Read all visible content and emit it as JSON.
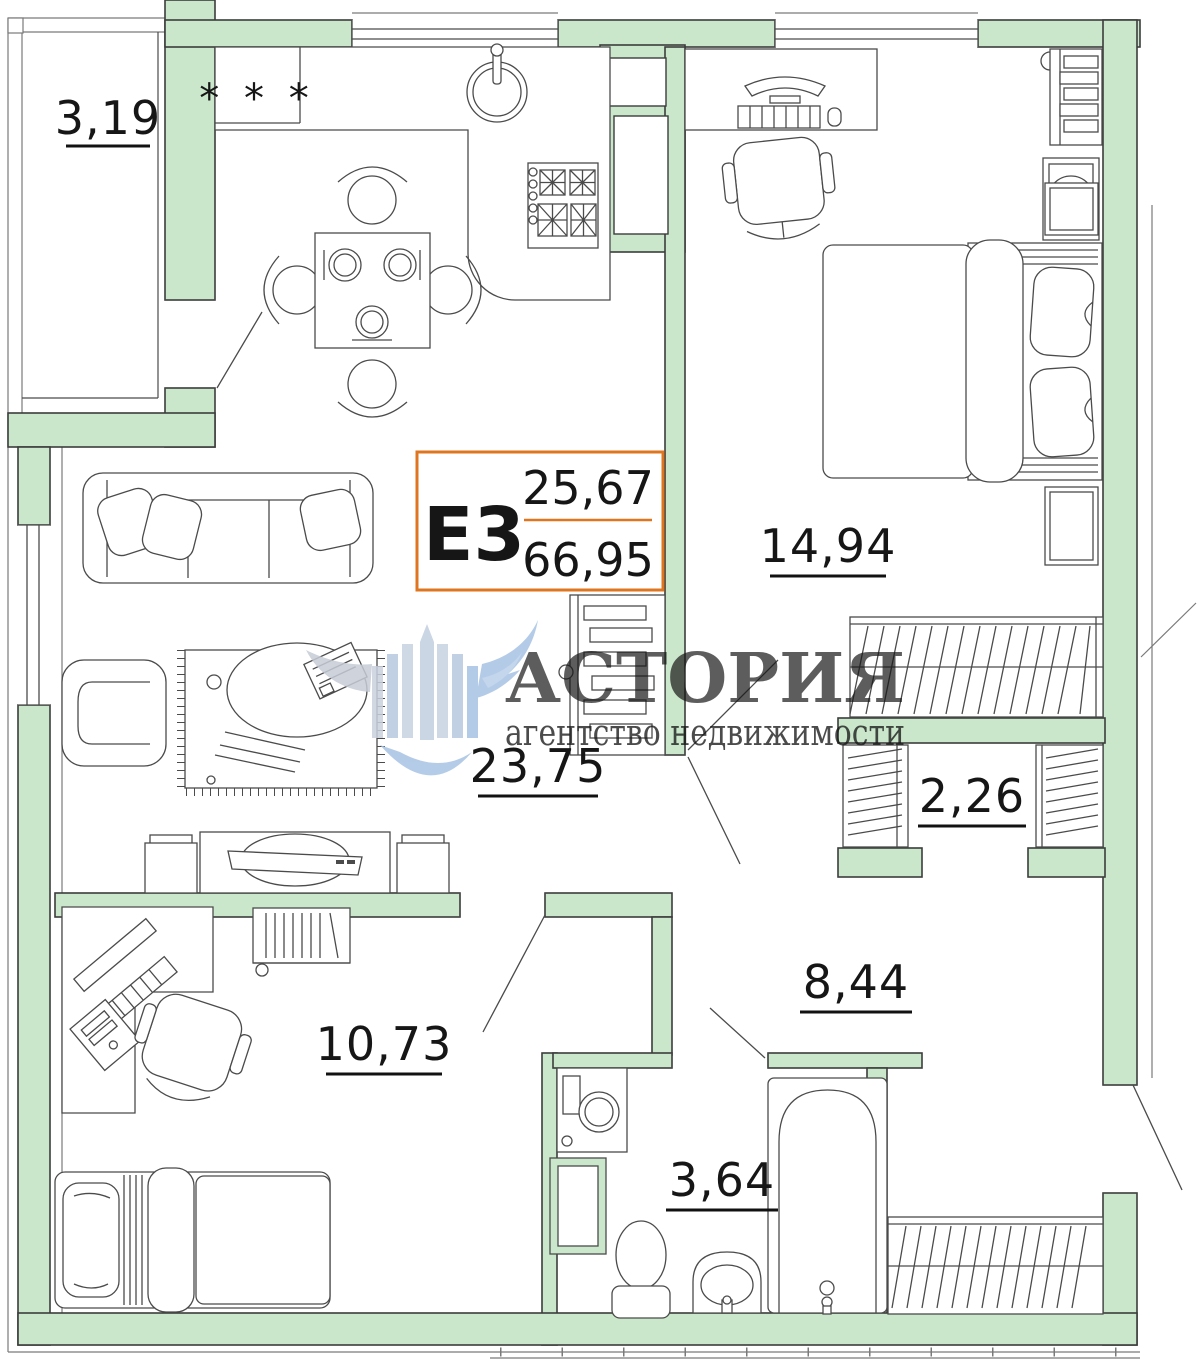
{
  "unit_card": {
    "code": "Е3",
    "area_top": "25,67",
    "area_bottom": "66,95"
  },
  "room_labels": {
    "balcony": "3,19",
    "kitchen_living": "23,75",
    "bedroom": "14,94",
    "closet": "2,26",
    "hallway": "8,44",
    "bedroom2": "10,73",
    "bathroom": "3,64"
  },
  "kitchen": {
    "counter_marks": "* * *"
  },
  "watermark": {
    "brand": "АСТОРИЯ",
    "tagline": "агентство недвижимости"
  },
  "colors": {
    "wall_fill": "#cbe7cb",
    "outline": "#3c3c3c",
    "unit_accent": "#e0751f",
    "watermark_pink": "#e7a1a0",
    "watermark_blue": "#a9c5e5"
  }
}
